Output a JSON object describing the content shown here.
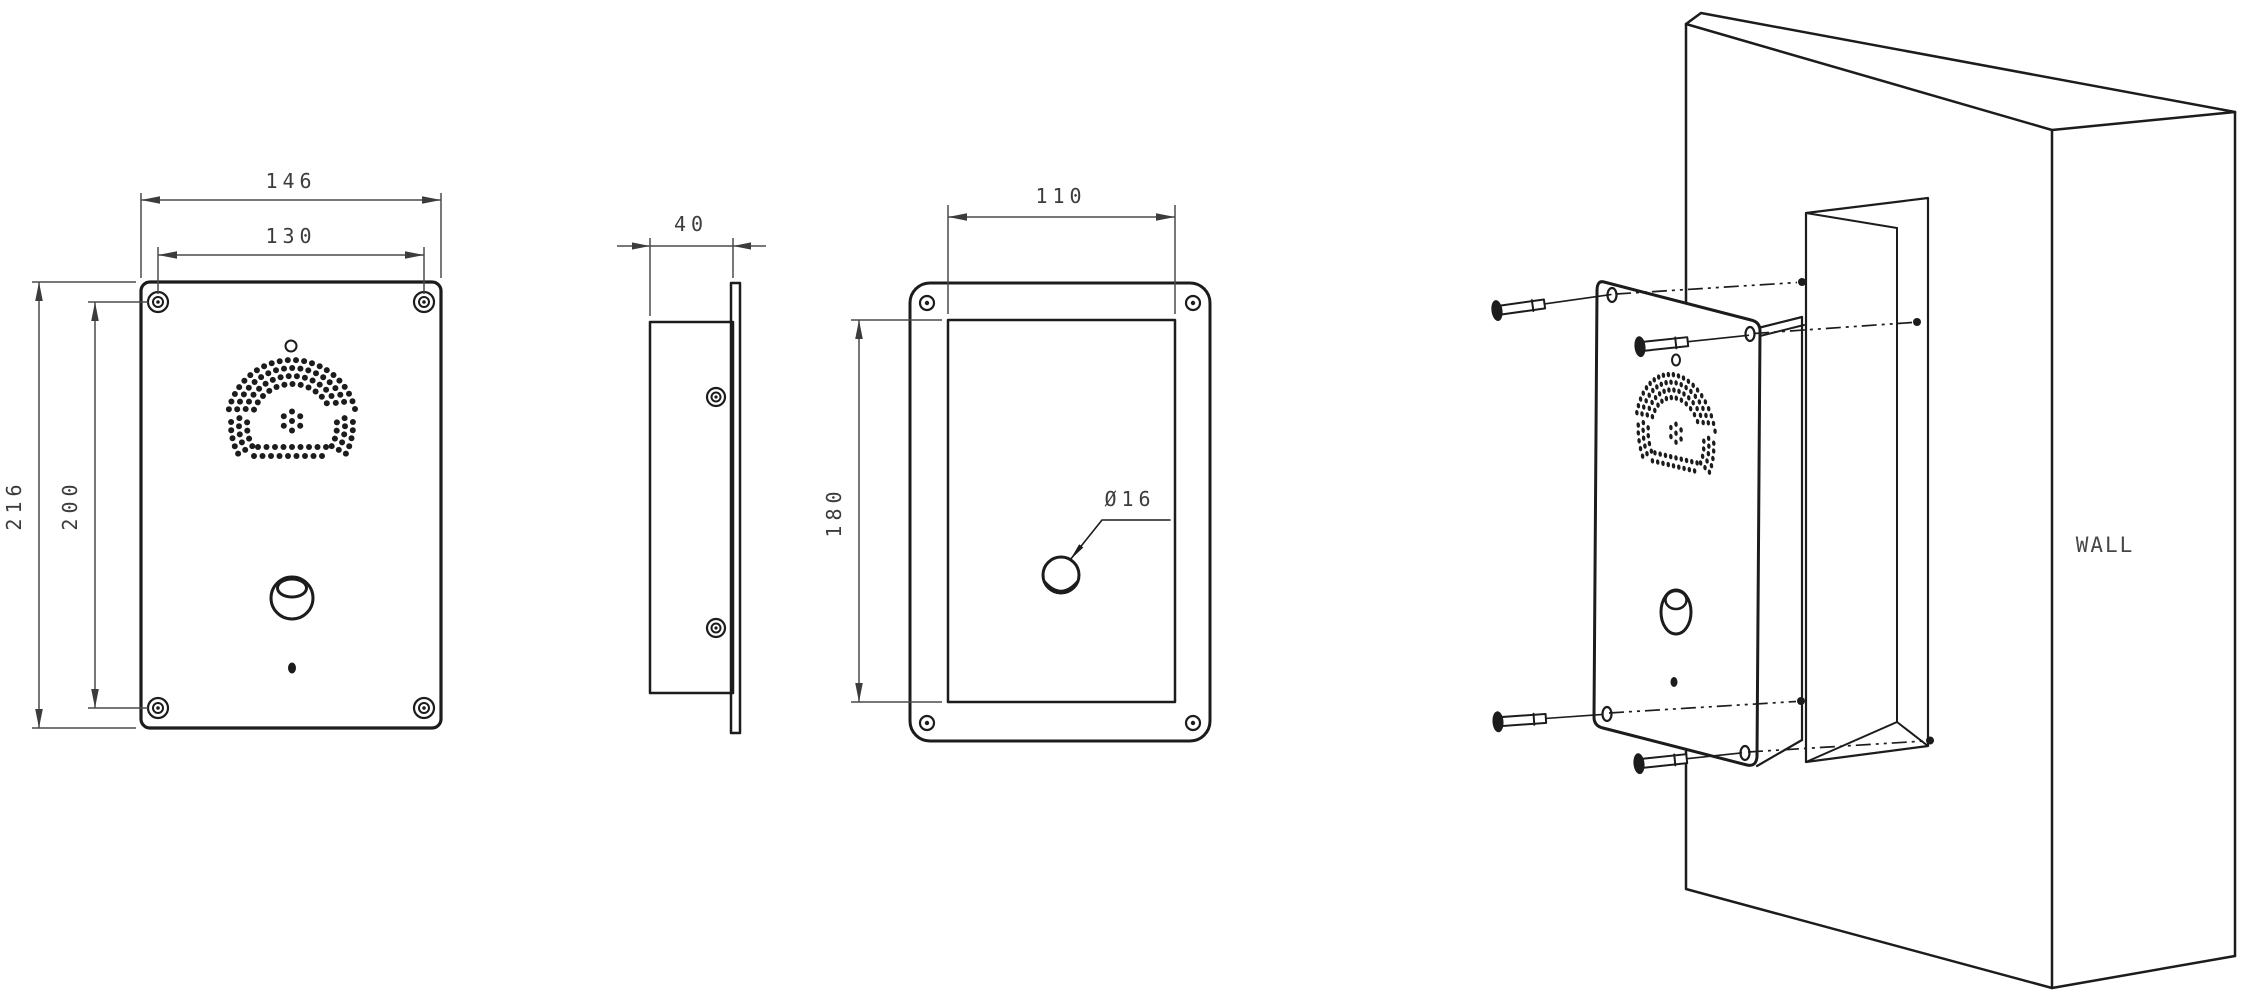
{
  "drawing": {
    "front_view": {
      "width_outer": "146",
      "width_inner": "130",
      "height_outer": "216",
      "height_inner": "200"
    },
    "side_view": {
      "depth": "40"
    },
    "rear_view": {
      "width": "110",
      "height": "180",
      "hole": "Ø16"
    },
    "wall_3d_view": {
      "label": "WALL"
    }
  },
  "colors": {
    "line": "#1c1c1c",
    "dim_line": "#4a4a4a",
    "text": "#3c3c3c",
    "background": "#ffffff"
  }
}
